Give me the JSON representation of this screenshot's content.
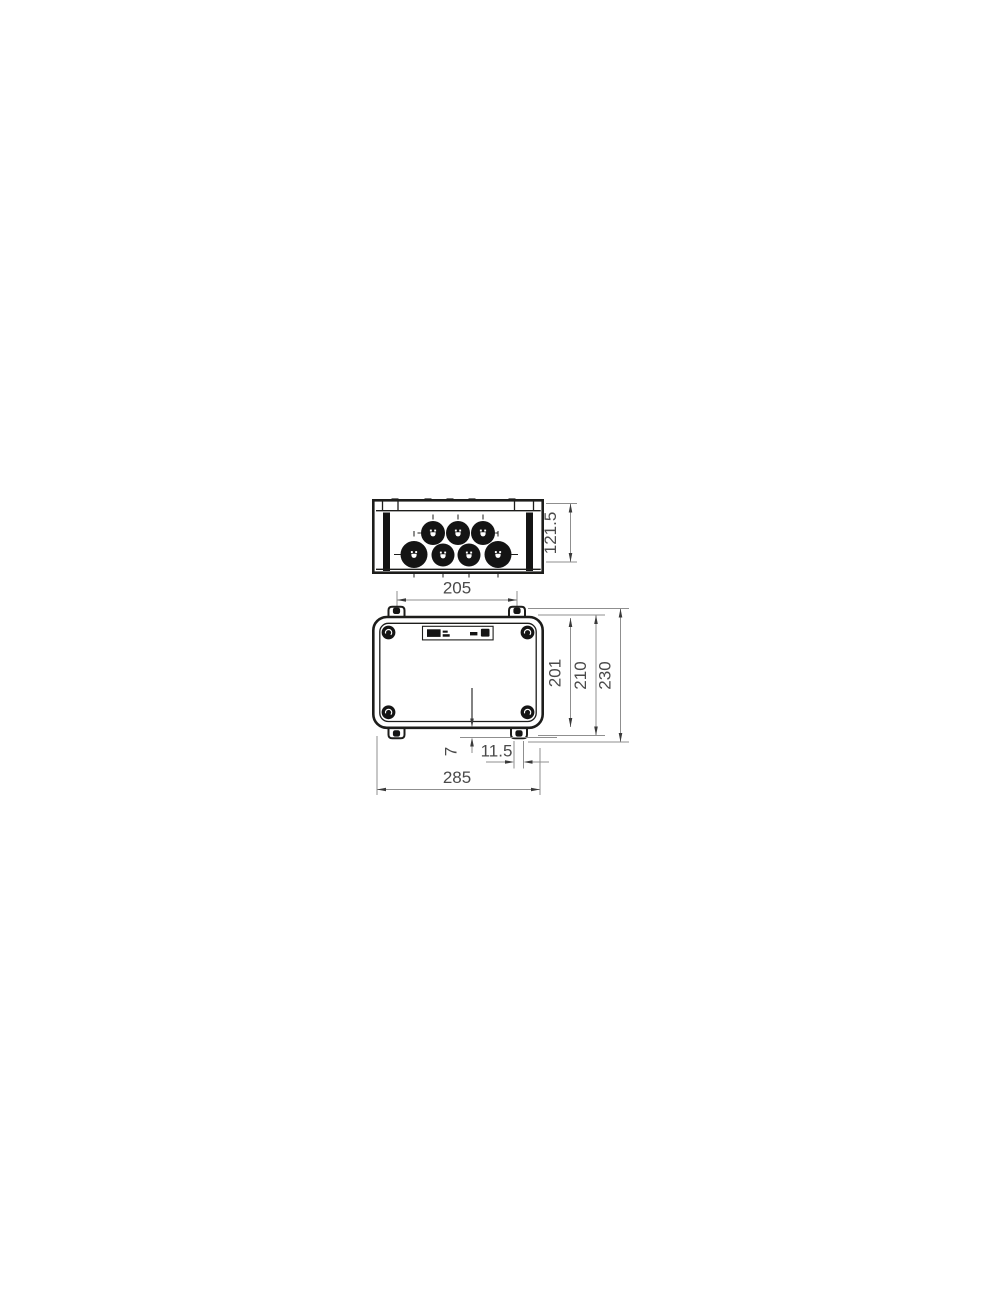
{
  "page": {
    "background": "#ffffff"
  },
  "drawing": {
    "kind": "two-view dimensional technical drawing of a cable junction box",
    "colors": {
      "outline": "#1d1d1b",
      "knockout_fill": "#141414",
      "dimension_line": "#8f8f8f",
      "arrowhead": "#3a3a3a",
      "dimension_text": "#4a4a4a"
    },
    "top_view": {
      "description": "side elevation with seven round cable-entry knockouts",
      "knockout_rows": [
        3,
        4
      ]
    },
    "front_view": {
      "description": "front elevation with four lid screws, four mounting tabs and a rating label"
    },
    "dimensions": {
      "depth": "121.5",
      "mounting_hole_spacing": "205",
      "inner_height": "201",
      "mid_height": "210",
      "overall_height": "230",
      "tab_protrusion": "7",
      "slot_width": "11.5",
      "overall_width": "285"
    }
  }
}
